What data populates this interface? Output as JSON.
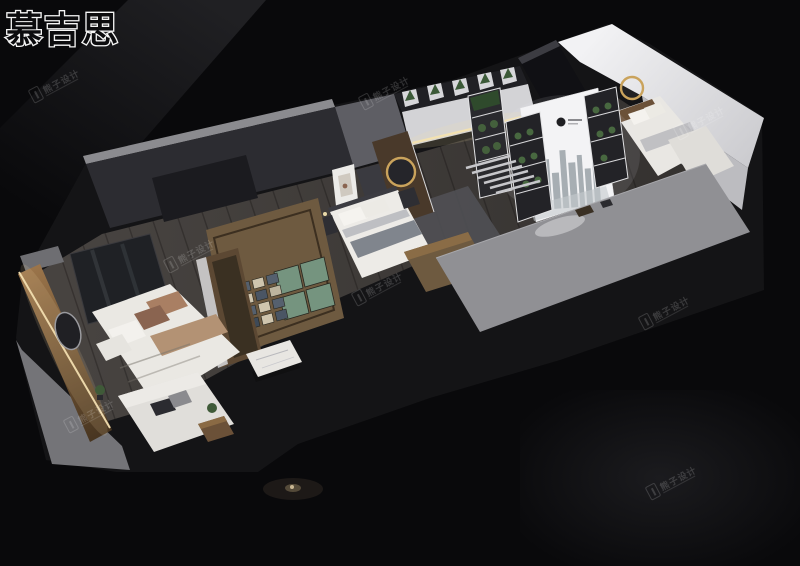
{
  "brand": {
    "name": "慕吉思"
  },
  "watermark": {
    "label": "熊子设计",
    "icon": "pillar-logo-icon"
  },
  "colors": {
    "background": "#08080a",
    "plinth_dark": "#141416",
    "wall_top_gray": "#8b8b8f",
    "wall_dark_face": "#2c2c31",
    "floor_wood": "#413d39",
    "warm_wood": "#6e5a40",
    "led_warm": "#f3e0b2",
    "bedding_white": "#eae8e3",
    "pillow_tan": "#a97f63",
    "panel_teal": "#75947f",
    "lightbox_white": "#f3f3f5",
    "platform_gray": "#909094",
    "gold_accent": "#caa35c",
    "plant_green": "#44603c"
  }
}
